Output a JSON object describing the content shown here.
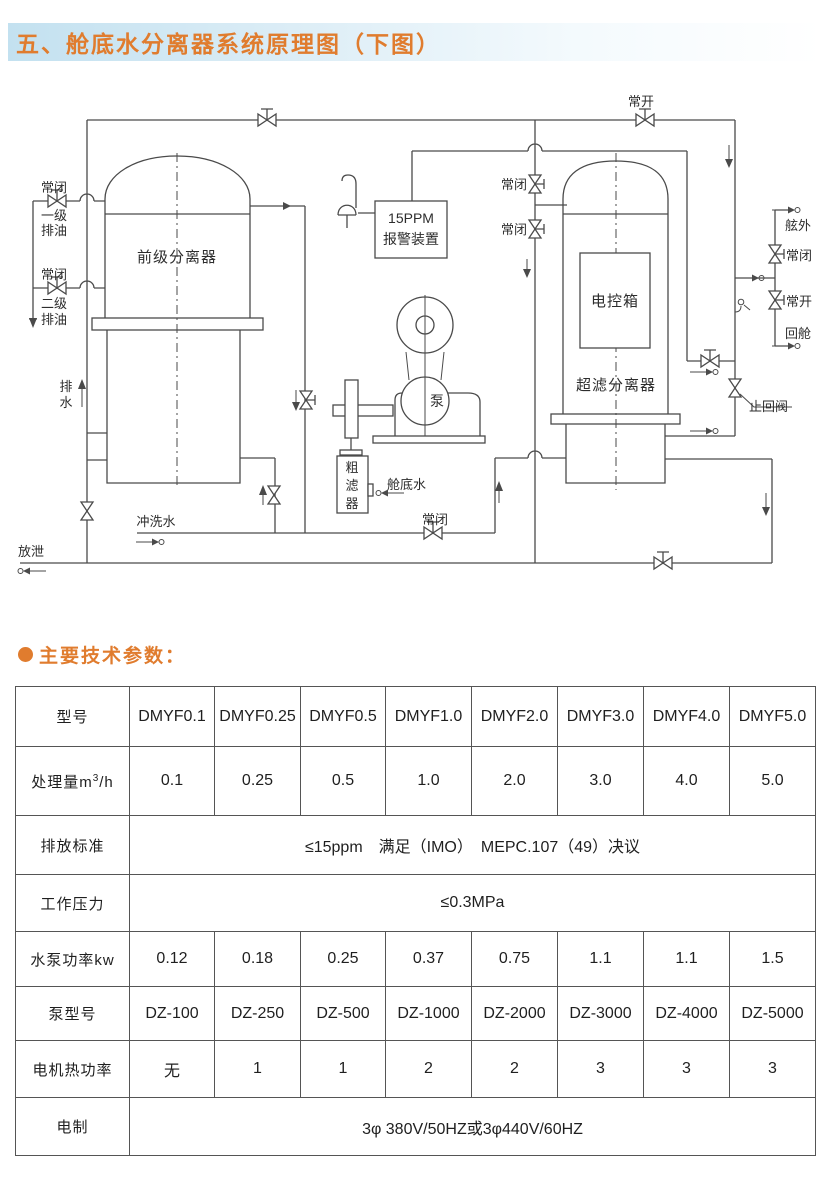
{
  "header": {
    "title": "五、舱底水分离器系统原理图（下图）",
    "accent_color": "#e07c2e",
    "band_color": "#c3e1f0"
  },
  "section": {
    "heading": "主要技术参数："
  },
  "diagram": {
    "labels": {
      "nc_oil1": "常闭",
      "oil1_l1": "一级",
      "oil1_l2": "排油",
      "nc_oil2": "常闭",
      "oil2_l1": "二级",
      "oil2_l2": "排油",
      "pre_separator": "前级分离器",
      "drain_l1": "排",
      "drain_l2": "水",
      "flush_water": "冲洗水",
      "release": "放泄",
      "alarm_l1": "15PPM",
      "alarm_l2": "报警装置",
      "pump": "泵",
      "strainer_c1": "粗",
      "strainer_c2": "滤",
      "strainer_c3": "器",
      "bilge_water": "舱底水",
      "nc_bottom": "常闭",
      "no_top": "常开",
      "nc_mid1": "常闭",
      "nc_mid2": "常闭",
      "control_box": "电控箱",
      "uf_separator": "超滤分离器",
      "outboard": "舷外",
      "nc_right": "常闭",
      "no_right": "常开",
      "return_cabin": "回舱",
      "check_valve": "止回阀"
    }
  },
  "table": {
    "rows": [
      {
        "label": "型号",
        "cells": [
          "DMYF0.1",
          "DMYF0.25",
          "DMYF0.5",
          "DMYF1.0",
          "DMYF2.0",
          "DMYF3.0",
          "DMYF4.0",
          "DMYF5.0"
        ]
      },
      {
        "label": "处理量m",
        "label_sup": "3",
        "label_suffix": "/h",
        "cells": [
          "0.1",
          "0.25",
          "0.5",
          "1.0",
          "2.0",
          "3.0",
          "4.0",
          "5.0"
        ]
      },
      {
        "label": "排放标准",
        "merged": "≤15ppm　满足（IMO）　MEPC.107（49）决议"
      },
      {
        "label": "工作压力",
        "merged": "≤0.3MPa"
      },
      {
        "label": "水泵功率kw",
        "cells": [
          "0.12",
          "0.18",
          "0.25",
          "0.37",
          "0.75",
          "1.1",
          "1.1",
          "1.5"
        ]
      },
      {
        "label": "泵型号",
        "cells": [
          "DZ-100",
          "DZ-250",
          "DZ-500",
          "DZ-1000",
          "DZ-2000",
          "DZ-3000",
          "DZ-4000",
          "DZ-5000"
        ]
      },
      {
        "label": "电机热功率",
        "cells": [
          "无",
          "1",
          "1",
          "2",
          "2",
          "3",
          "3",
          "3"
        ]
      },
      {
        "label": "电制",
        "merged": "3φ 380V/50HZ或3φ440V/60HZ"
      }
    ]
  }
}
